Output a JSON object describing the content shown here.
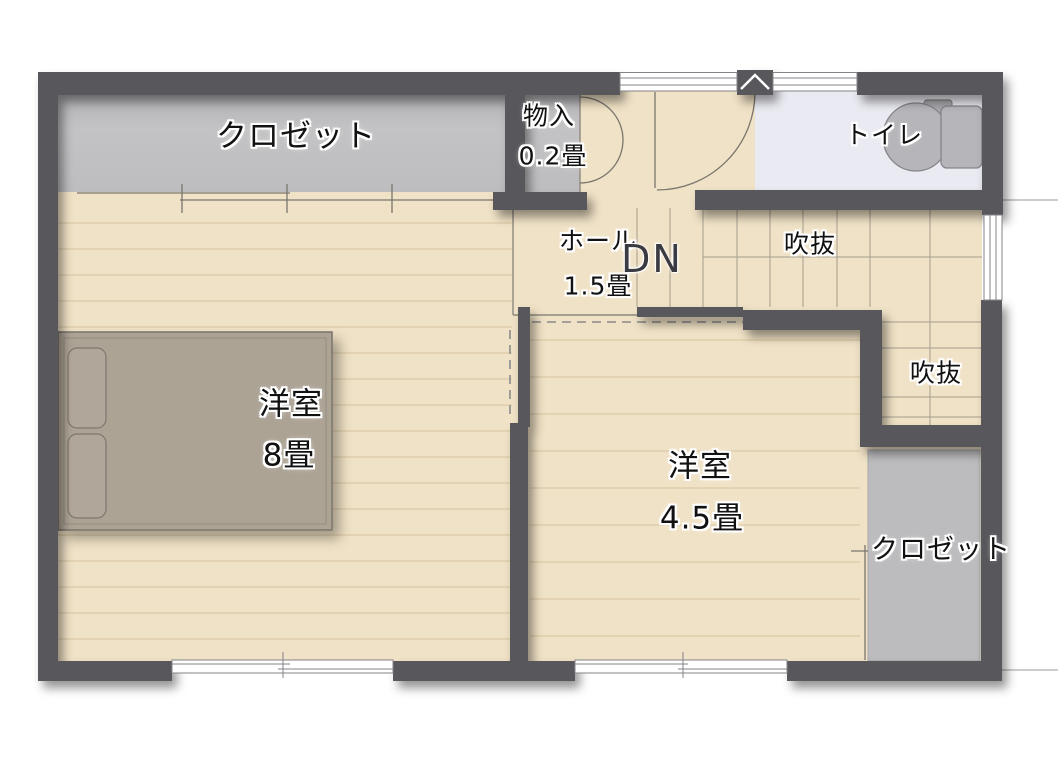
{
  "plan": {
    "type": "floor-plan",
    "floor_labels": {
      "closet_top": "クロゼット",
      "storage_name": "物入",
      "storage_area": "0.2畳",
      "toilet": "トイレ",
      "hall_name": "ホール",
      "hall_area": "1.5畳",
      "stairs_direction": "DN",
      "void_upper": "吹抜",
      "void_lower": "吹抜",
      "bedroom8_name": "洋室",
      "bedroom8_area": "8畳",
      "bedroom45_name": "洋室",
      "bedroom45_area": "4.5畳",
      "closet_bottom": "クロゼット"
    },
    "colors": {
      "wall": "#58585c",
      "floor": "#f0e2c6",
      "floor_line": "#dccaa6",
      "closet_fill": "#c0c0c2",
      "toilet_floor": "#eaeaf2",
      "bed_fill": "#aca395",
      "text": "#111111"
    }
  }
}
